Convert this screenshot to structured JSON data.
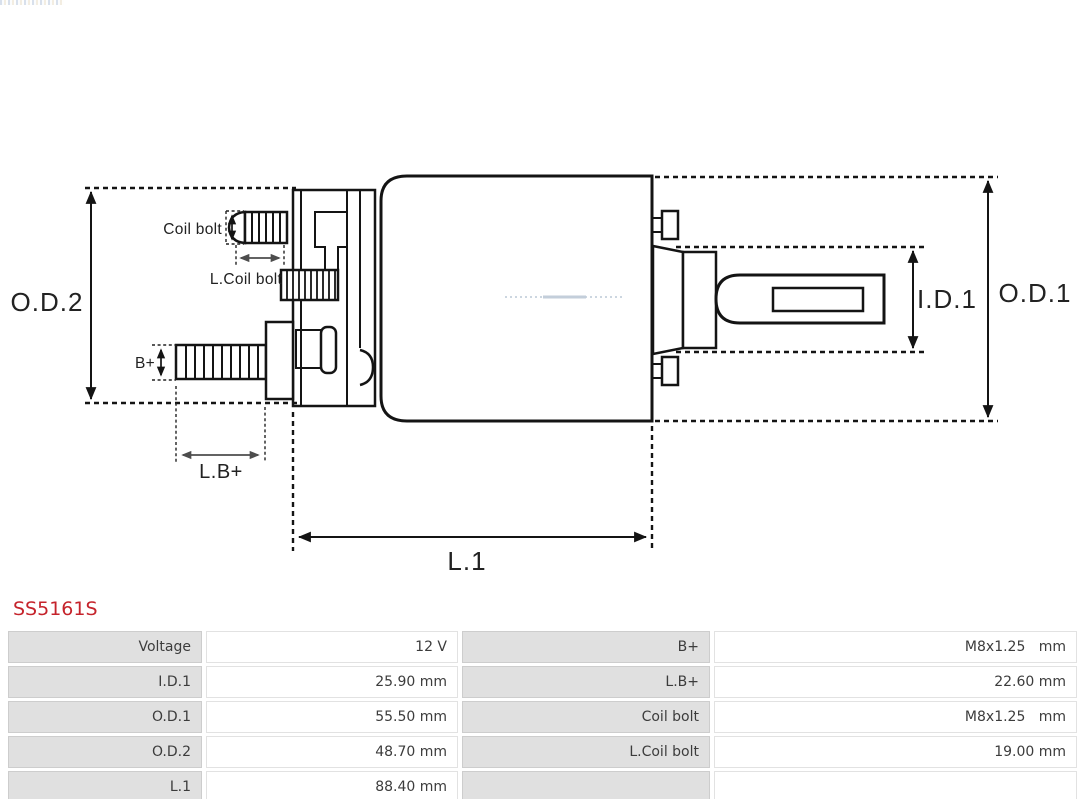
{
  "part_number": "SS5161S",
  "accent_color": "#c5232b",
  "diagram": {
    "labels": {
      "od2": "O.D.2",
      "od1": "O.D.1",
      "id1": "I.D.1",
      "l1": "L.1",
      "lbplus": "L.B+",
      "bplus": "B+",
      "coil_bolt": "Coil bolt",
      "l_coil_bolt": "L.Coil bolt"
    }
  },
  "table": {
    "rows": [
      {
        "label_left": "Voltage",
        "value_left": "12 V",
        "label_right": "B+",
        "value_right": "M8x1.25   mm"
      },
      {
        "label_left": "I.D.1",
        "value_left": "25.90 mm",
        "label_right": "L.B+",
        "value_right": "22.60 mm"
      },
      {
        "label_left": "O.D.1",
        "value_left": "55.50 mm",
        "label_right": "Coil bolt",
        "value_right": "M8x1.25   mm"
      },
      {
        "label_left": "O.D.2",
        "value_left": "48.70 mm",
        "label_right": "L.Coil bolt",
        "value_right": "19.00 mm"
      },
      {
        "label_left": "L.1",
        "value_left": "88.40 mm",
        "label_right": "",
        "value_right": ""
      }
    ]
  }
}
